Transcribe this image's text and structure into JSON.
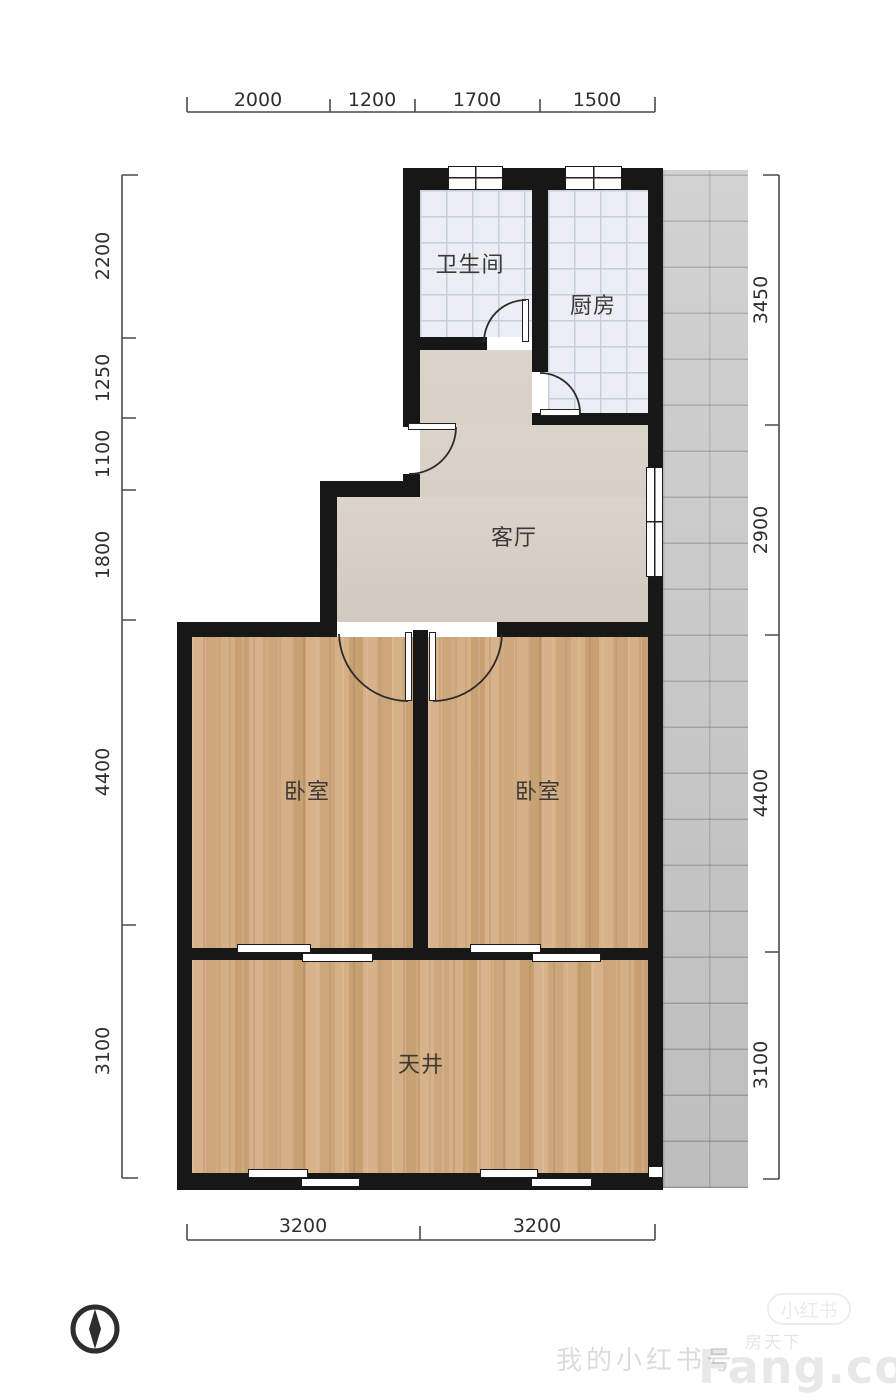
{
  "rooms": [
    {
      "id": "bathroom",
      "label": "卫生间"
    },
    {
      "id": "kitchen",
      "label": "厨房"
    },
    {
      "id": "living-room",
      "label": "客厅"
    },
    {
      "id": "bedroom-left",
      "label": "卧室"
    },
    {
      "id": "bedroom-right",
      "label": "卧室"
    },
    {
      "id": "courtyard",
      "label": "天井"
    }
  ],
  "dimensions_mm": {
    "top": [
      "2000",
      "1200",
      "1700",
      "1500"
    ],
    "left": [
      "2200",
      "1250",
      "1100",
      "1800",
      "4400",
      "3100"
    ],
    "right": [
      "3450",
      "2900",
      "4400",
      "3100"
    ],
    "bottom": [
      "3200",
      "3200"
    ]
  },
  "watermarks": {
    "account_text": "我的小红书号",
    "site_logo": "Fang.com",
    "site_name_cn": "房天下",
    "badge": "小红书"
  },
  "icons": {
    "compass": "compass-north-icon"
  },
  "colors": {
    "wall": "#171717",
    "tile_floor": "#eceef6",
    "tile_grid": "#c7cddd",
    "wood_floor": "#d2ac82",
    "living_floor": "#d9d1c7",
    "pavement": "#c8c8c8",
    "dimension_text": "#2f2f2f"
  }
}
